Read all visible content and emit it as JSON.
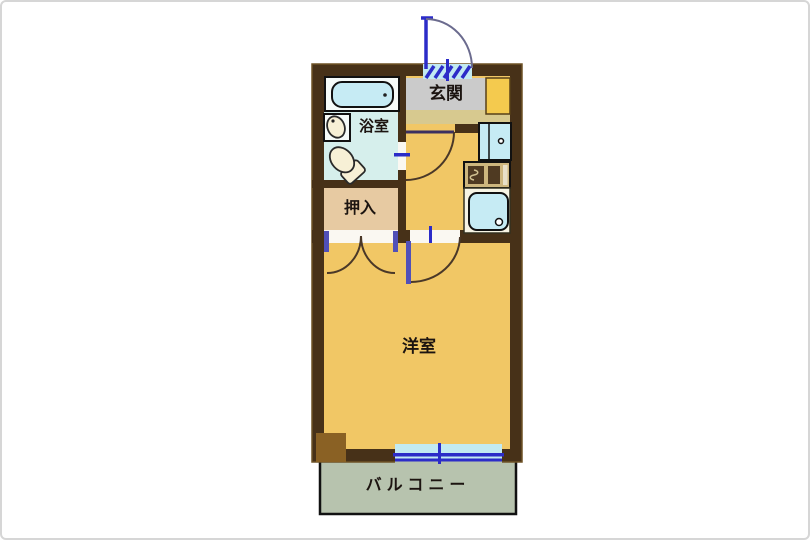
{
  "plan": {
    "type": "apartment-floor-plan",
    "labels": {
      "entrance": "玄関",
      "bathroom": "浴室",
      "closet": "押入",
      "western_room": "洋室",
      "balcony": "バルコニー"
    },
    "fixtures": [
      "entrance-swing-door",
      "bathtub",
      "washbasin",
      "toilet",
      "interior-swing-door",
      "closet-double-doors",
      "room-swing-door",
      "washing-machine",
      "gas-stove",
      "kitchen-sink",
      "balcony-sliding-window",
      "corner-pillar"
    ]
  },
  "colors": {
    "background": "#ffffff",
    "wall": "#473118",
    "wall_edge": "#6e5226",
    "floor": "#f1c765",
    "bathroom_floor": "#d6efec",
    "closet_floor": "#e7caa2",
    "entrance_floor": "#cbcbcb",
    "step": "#d7c98f",
    "cabinet": "#f4ca4e",
    "balcony_floor": "#b7c3ae",
    "fixture_cyan": "#c6ebf4",
    "ceramic": "#f7f0d6",
    "door_blue": "#2c2cc8",
    "door_post": "#5050b8",
    "arc": "#4a3828",
    "entrance_arc": "#6b6b8e",
    "outline": "#111111",
    "pillar": "#8a6124"
  }
}
